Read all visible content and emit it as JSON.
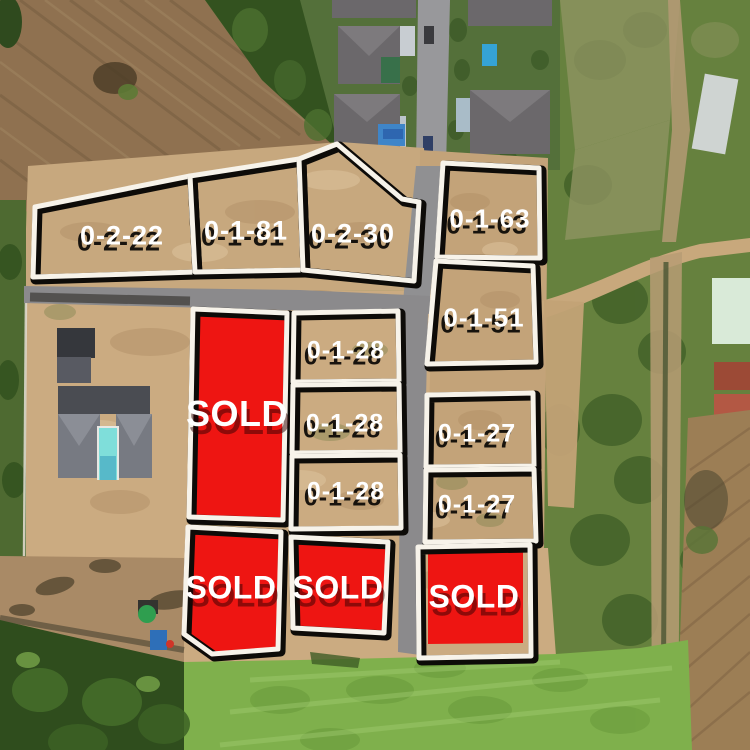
{
  "image_type": "aerial drone photo of a land subdivision with plot overlay",
  "sold_label": "SOLD",
  "palette": {
    "sold_red": "#ee1512",
    "outline_white": "#f7f3ea",
    "outline_black": "#0d0b08",
    "label_text": "#ffffff",
    "sand": "#c7a87e",
    "road": "#8b8a8c",
    "field": "#8f7150",
    "grass": "#7fb04c",
    "scrub": "#66813e",
    "trees_dark": "#33521f",
    "roof_gray": "#6b686b",
    "pool_cyan": "#7fdeda",
    "dirt_track": "#c8a87c"
  },
  "plots": [
    {
      "id": "0-2-22",
      "label": "0-2-22",
      "status": "available",
      "points": "35,207 190,176 195,272 33,277",
      "label_pos": [
        122,
        236
      ],
      "font_size": 27
    },
    {
      "id": "0-1-81",
      "label": "0-1-81",
      "status": "available",
      "points": "190,176 299,159 303,270 195,272",
      "label_pos": [
        246,
        231
      ],
      "font_size": 27
    },
    {
      "id": "0-2-30",
      "label": "0-2-30",
      "status": "available",
      "points": "299,159 337,144 402,199 419,202 414,281 303,270",
      "label_pos": [
        353,
        234
      ],
      "font_size": 27
    },
    {
      "id": "0-1-63",
      "label": "0-1-63",
      "status": "available",
      "points": "443,163 539,168 540,258 437,257",
      "label_pos": [
        490,
        219
      ],
      "font_size": 26
    },
    {
      "id": "0-1-51",
      "label": "0-1-51",
      "status": "available",
      "points": "436,261 533,266 536,362 427,364",
      "label_pos": [
        484,
        318
      ],
      "font_size": 26
    },
    {
      "id": "sold-1",
      "label": "SOLD",
      "status": "sold",
      "points": "193,309 287,313 283,520 189,517",
      "label_pos": [
        237,
        414
      ],
      "font_size": 36
    },
    {
      "id": "0-1-28-a",
      "label": "0-1-28",
      "status": "available",
      "points": "294,313 398,311 399,381 293,382",
      "label_pos": [
        346,
        351
      ],
      "font_size": 25
    },
    {
      "id": "0-1-28-b",
      "label": "0-1-28",
      "status": "available",
      "points": "293,385 399,384 400,452 292,453",
      "label_pos": [
        345,
        424
      ],
      "font_size": 25
    },
    {
      "id": "0-1-28-c",
      "label": "0-1-28",
      "status": "available",
      "points": "292,456 400,455 401,528 291,529",
      "label_pos": [
        346,
        492
      ],
      "font_size": 25
    },
    {
      "id": "0-1-27-a",
      "label": "0-1-27",
      "status": "available",
      "points": "427,395 533,393 534,466 426,467",
      "label_pos": [
        477,
        434
      ],
      "font_size": 25
    },
    {
      "id": "0-1-27-b",
      "label": "0-1-27",
      "status": "available",
      "points": "426,470 534,469 536,541 425,542",
      "label_pos": [
        477,
        505
      ],
      "font_size": 25
    },
    {
      "id": "sold-2",
      "label": "SOLD",
      "status": "sold",
      "points": "188,527 281,532 278,649 212,654 184,634",
      "label_pos": [
        231,
        588
      ],
      "font_size": 32
    },
    {
      "id": "sold-3",
      "label": "SOLD",
      "status": "sold",
      "points": "291,537 388,542 384,633 293,628",
      "label_pos": [
        338,
        588
      ],
      "font_size": 32
    },
    {
      "id": "sold-4",
      "label": "SOLD",
      "status": "sold",
      "points": "418,547 530,545 531,656 419,658",
      "red_inset": "428,552 523,551 523,643 428,644",
      "label_pos": [
        474,
        597
      ],
      "font_size": 32
    }
  ]
}
